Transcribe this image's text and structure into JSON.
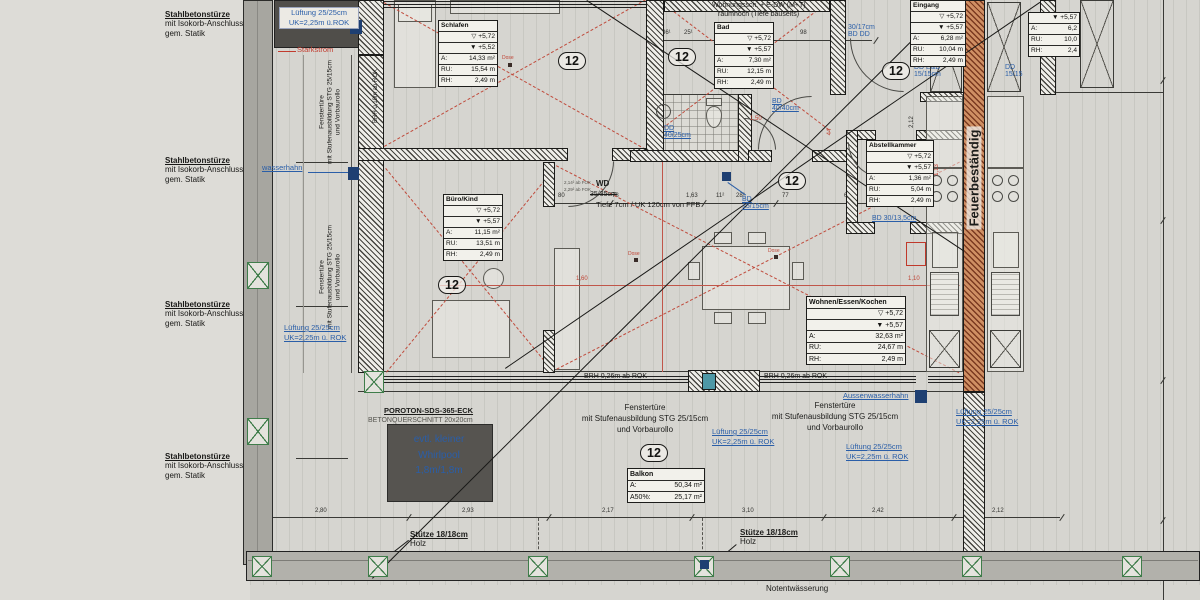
{
  "notes": {
    "lintel": {
      "title": "Stahlbetonstürze",
      "l2": "mit Isokorb-Anschluss",
      "l3": "gem. Statik"
    }
  },
  "labels": {
    "lueftung_box": {
      "l1": "Lüftung 25/25cm",
      "l2": "UK=2,25m ü.ROK"
    },
    "lueftung": {
      "l1": "Lüftung 25/25cm",
      "l2": "UK=2,25m ü. ROK"
    },
    "starkstrom": "Starkstrom",
    "wasserhahn": "wasserhahn",
    "aussenwasserhahn": "Aussenwasserhahn",
    "fenstertuer": {
      "l1": "Fenstertüre",
      "l2": "mit Stufenausbildung STG 25/15cm",
      "l3": "und Vorbaurollo"
    },
    "brh026": "BRH 0,26m ab ROK",
    "brh010": "BRH 0,10m ab ROK",
    "wd": "WD",
    "wd_old": "35/35cm",
    "wd_note": "Tiefe 7cm / UK 120cm von FFB",
    "fok1": "2,14² ab FOK",
    "fok2": "2,29² ab FOK",
    "schrank1": "Wohnungssch. + E-DW (M+T)",
    "schrank2": "raumhoch (Tiefe bauseits)",
    "poroton1": "POROTON-SDS-365-ECK",
    "poroton2": "BETONQUERSCHNITT 20x20cm",
    "whirlpool": {
      "l1": "evtl. kleiner",
      "l2": "Whirlpool",
      "l3": "1,8m/1,8m"
    },
    "stuetze1": "Stütze 18/18cm",
    "stuetze2": "Holz",
    "notentwaesserung": "Notentwässerung",
    "feuerbestaendig": "Feuerbeständig",
    "dd4025": {
      "l1": "DD",
      "l2": "40/25cm"
    },
    "bd4040": {
      "l1": "BD",
      "l2": "40/40cm"
    },
    "bd1515": {
      "l1": "BD",
      "l2": "15/15cm"
    },
    "dded": {
      "l1": "DD E&D",
      "l2": "15/15cm"
    },
    "ddr": {
      "l1": "DD",
      "l2": "15/15"
    },
    "bd3017": {
      "l1": "30/17cm",
      "l2": "BD DD"
    },
    "bd30135": "BD 30/13,5cm",
    "dose": "Dose",
    "unit": "12"
  },
  "rooms": {
    "schlafen": {
      "name": "Schlafen",
      "lvl1": "▽ +5,72",
      "lvl2": "▼ +5,52",
      "aL": "A:",
      "a": "14,33 m²",
      "ruL": "RU:",
      "ru": "15,54 m",
      "rhL": "RH:",
      "rh": "2,49 m"
    },
    "bad": {
      "name": "Bad",
      "lvl1": "▽ +5,72",
      "lvl2": "▼ +5,57",
      "aL": "A:",
      "a": "7,30 m²",
      "ruL": "RU:",
      "ru": "12,15 m",
      "rhL": "RH:",
      "rh": "2,49 m"
    },
    "eingang": {
      "name": "Eingang",
      "lvl1": "▽ +5,72",
      "lvl2": "▼ +5,57",
      "aL": "A:",
      "a": "6,28 m²",
      "ruL": "RU:",
      "ru": "10,04 m",
      "rhL": "RH:",
      "rh": "2,49 m"
    },
    "abstellkammer": {
      "name": "Abstellkammer",
      "lvl1": "▽ +5,72",
      "lvl2": "▼ +5,57",
      "aL": "A:",
      "a": "1,36 m²",
      "ruL": "RU:",
      "ru": "5,04 m",
      "rhL": "RH:",
      "rh": "2,49 m"
    },
    "buero": {
      "name": "Büro/Kind",
      "lvl1": "▽ +5,72",
      "lvl2": "▼ +5,57",
      "aL": "A:",
      "a": "11,15 m²",
      "ruL": "RU:",
      "ru": "13,51 m",
      "rhL": "RH:",
      "rh": "2,49 m"
    },
    "wohnen": {
      "name": "Wohnen/Essen/Kochen",
      "lvl1": "▽ +5,72",
      "lvl2": "▼ +5,57",
      "aL": "A:",
      "a": "32,63 m²",
      "ruL": "RU:",
      "ru": "24,67 m",
      "rhL": "RH:",
      "rh": "2,49 m"
    },
    "nachbar": {
      "lvl2": "▼ +5,57",
      "aL": "A:",
      "a": "6,2",
      "ruL": "RU:",
      "ru": "10,0",
      "rhL": "RH:",
      "rh": "2,4"
    },
    "balkon": {
      "name": "Balkon",
      "aL": "A:",
      "a": "50,34 m²",
      "a50L": "A50%:",
      "a50": "25,17 m²"
    }
  },
  "dims": {
    "bottom": [
      "2,80",
      "2,93",
      "2,17",
      "3,10",
      "2,42",
      "2,12"
    ],
    "mid": [
      "80",
      "78",
      "1,63",
      "11²",
      "28²",
      "77",
      "69²"
    ],
    "top": [
      "36¹",
      "25¹",
      "1,50",
      "98"
    ],
    "red": [
      "1,60",
      "1,10",
      "1,50",
      "44",
      "1,13"
    ],
    "left": [
      "2,88",
      "2,68",
      "2,68"
    ]
  }
}
